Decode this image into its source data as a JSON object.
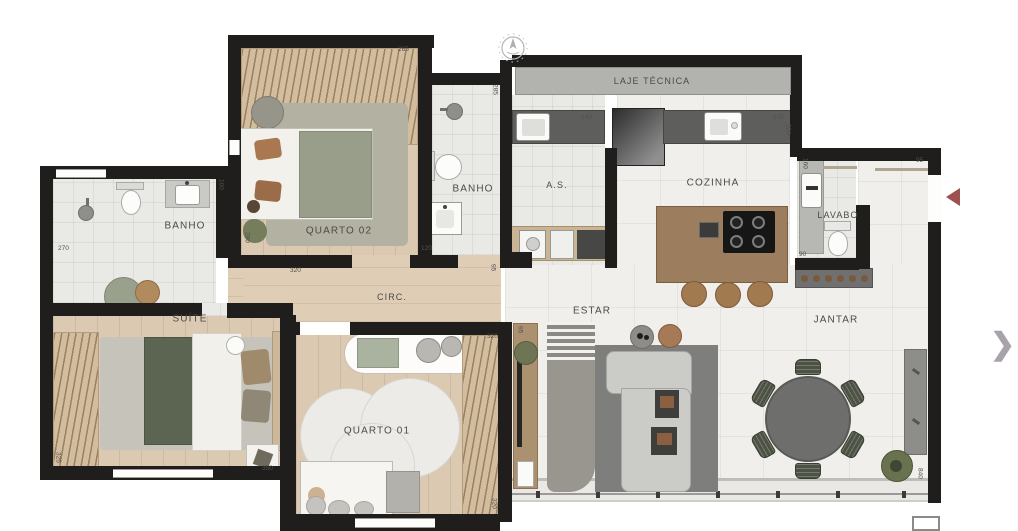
{
  "plan": {
    "rooms": {
      "quarto02": "QUARTO 02",
      "banho_suite": "BANHO",
      "banho_social": "BANHO",
      "laje_tecnica": "LAJE TÉCNICA",
      "area_servico": "A.S.",
      "cozinha": "COZINHA",
      "lavabo": "LAVABO",
      "suite": "SUÍTE",
      "circulacao": "CIRC.",
      "quarto01": "QUARTO 01",
      "estar": "ESTAR",
      "jantar": "JANTAR"
    },
    "dims": {
      "quarto02_width": "265",
      "quarto02_left": "280",
      "quarto02_bottom": "320",
      "banho_social_height": "285",
      "banho_social_width": "120",
      "banho_social_corner": "95",
      "as_counter": "140",
      "cozinha_counter": "275",
      "cozinha_depth": "220",
      "banho_suite_counter": "100",
      "banho_suite_width": "270",
      "suite_height": "325",
      "suite_width": "350",
      "quarto01_width": "320",
      "estar_wall": "95",
      "quarto01_height": "320",
      "lavabo_height": "160",
      "entry_width": "95",
      "lavabo_width": "90",
      "jantar_height": "840"
    },
    "icons": {
      "next_chevron": "❯"
    },
    "colors": {
      "wall": "#1f1e1c",
      "wood_floor": "#dbc9b2",
      "tile_floor": "#e9e9e6",
      "accent_arrow": "#9d5151",
      "chevron": "#a8a2aa"
    }
  }
}
